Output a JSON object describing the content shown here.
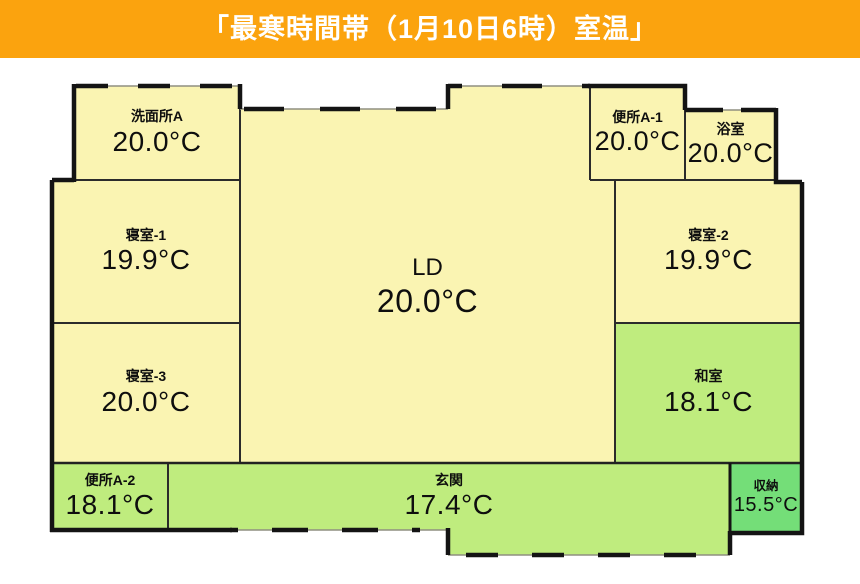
{
  "header": {
    "title": "「最寒時間帯（1月10日6時）室温」"
  },
  "colors": {
    "header_bg": "#FBA30E",
    "header_text": "#FFFFFF",
    "room_warm_fill": "#FAF4B2",
    "room_cool_fill": "#BFEC7E",
    "room_cold_fill": "#74DE78",
    "wall": "#141414",
    "background": "#FFFFFF"
  },
  "rooms": [
    {
      "id": "washroom-a",
      "label": "洗面所A",
      "temp": "20.0°C"
    },
    {
      "id": "bedroom-1",
      "label": "寝室-1",
      "temp": "19.9°C"
    },
    {
      "id": "ld",
      "label": "LD",
      "temp": "20.0°C"
    },
    {
      "id": "toilet-a1",
      "label": "便所A-1",
      "temp": "20.0°C"
    },
    {
      "id": "bathroom",
      "label": "浴室",
      "temp": "20.0°C"
    },
    {
      "id": "bedroom-2",
      "label": "寝室-2",
      "temp": "19.9°C"
    },
    {
      "id": "bedroom-3",
      "label": "寝室-3",
      "temp": "20.0°C"
    },
    {
      "id": "japanese-room",
      "label": "和室",
      "temp": "18.1°C"
    },
    {
      "id": "toilet-a2",
      "label": "便所A-2",
      "temp": "18.1°C"
    },
    {
      "id": "entrance",
      "label": "玄関",
      "temp": "17.4°C"
    },
    {
      "id": "storage",
      "label": "収納",
      "temp": "15.5°C"
    }
  ]
}
